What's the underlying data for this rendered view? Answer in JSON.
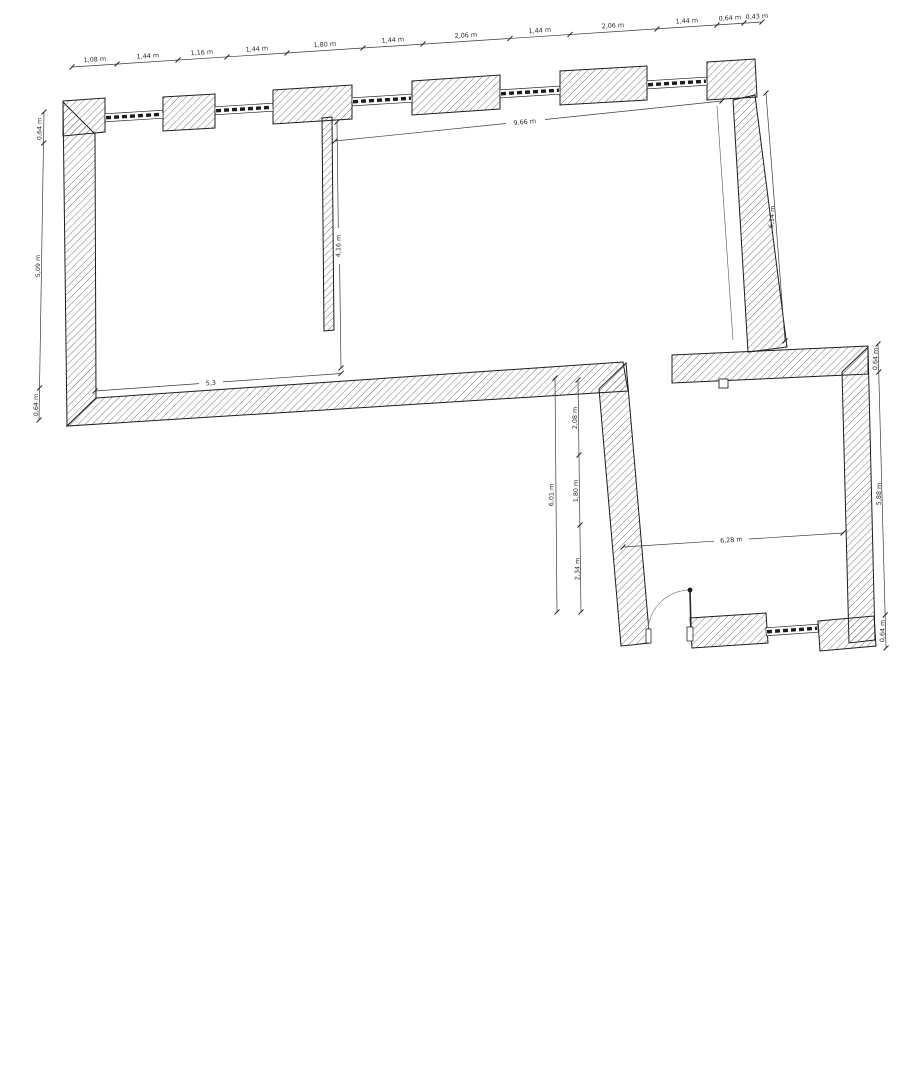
{
  "canvas": {
    "background": "#ffffff",
    "ink": "#1c1c1c",
    "hatch_color": "#6a6a6a"
  },
  "plan": {
    "unit_suffix": "m",
    "top_chain": [
      "1,08 m",
      "1,44 m",
      "1,16 m",
      "1,44 m",
      "1,80 m",
      "1,44 m",
      "2,06 m",
      "1,44 m",
      "2,06 m",
      "1,44 m",
      "0,64 m",
      "0,43 m"
    ],
    "left_chain": [
      "0,64 m",
      "5,09 m",
      "0,64 m"
    ],
    "interior_width_top": "9,66 m",
    "interior_height_left": "4,16 m",
    "interior_width_bottom": "5,3",
    "right_wall_height": "6,14 m",
    "mid_overall_height": "6,01 m",
    "mid_chain": [
      "2,08 m",
      "1,80 m",
      "2,34 m"
    ],
    "room2_interior_width": "6,28 m",
    "room2_right_chain": [
      "0,64 m",
      "5,88 m",
      "0,64 m"
    ]
  }
}
